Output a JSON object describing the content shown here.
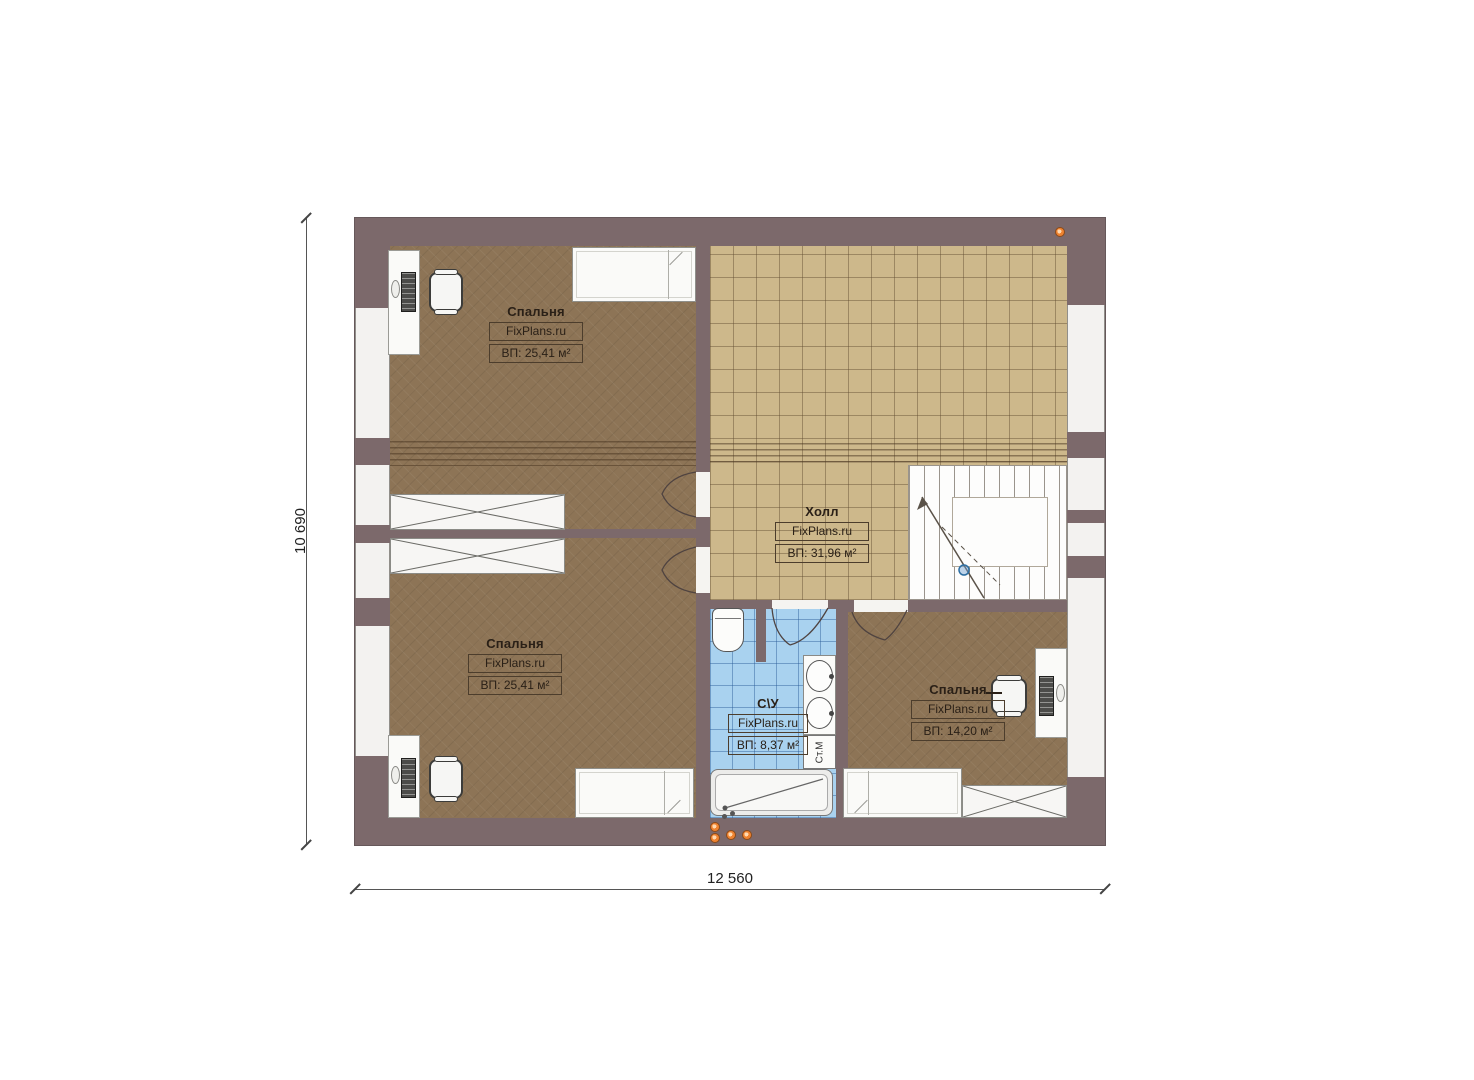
{
  "plan": {
    "dimensions": {
      "height_label": "10 690",
      "width_label": "12 560"
    },
    "rooms": [
      {
        "name": "Спальня",
        "brand": "FixPlans.ru",
        "area": "ВП: 25,41 м²"
      },
      {
        "name": "Холл",
        "brand": "FixPlans.ru",
        "area": "ВП: 31,96 м²"
      },
      {
        "name": "Спальня",
        "brand": "FixPlans.ru",
        "area": "ВП: 25,41 м²"
      },
      {
        "name": "С\\У",
        "brand": "FixPlans.ru",
        "area": "ВП: 8,37 м²"
      },
      {
        "name": "Спальня",
        "brand": "FixPlans.ru",
        "area": "ВП: 14,20 м²"
      }
    ],
    "labels": {
      "washing_machine": "Ст.М"
    },
    "colors": {
      "wall": "#7c696b",
      "carpet": "#8d7456",
      "hall_tile": "#cdb88b",
      "bath_tile": "#a9d2ef",
      "accent_orange": "#ef8330",
      "stair_marker_blue": "#2d6fa3"
    }
  }
}
